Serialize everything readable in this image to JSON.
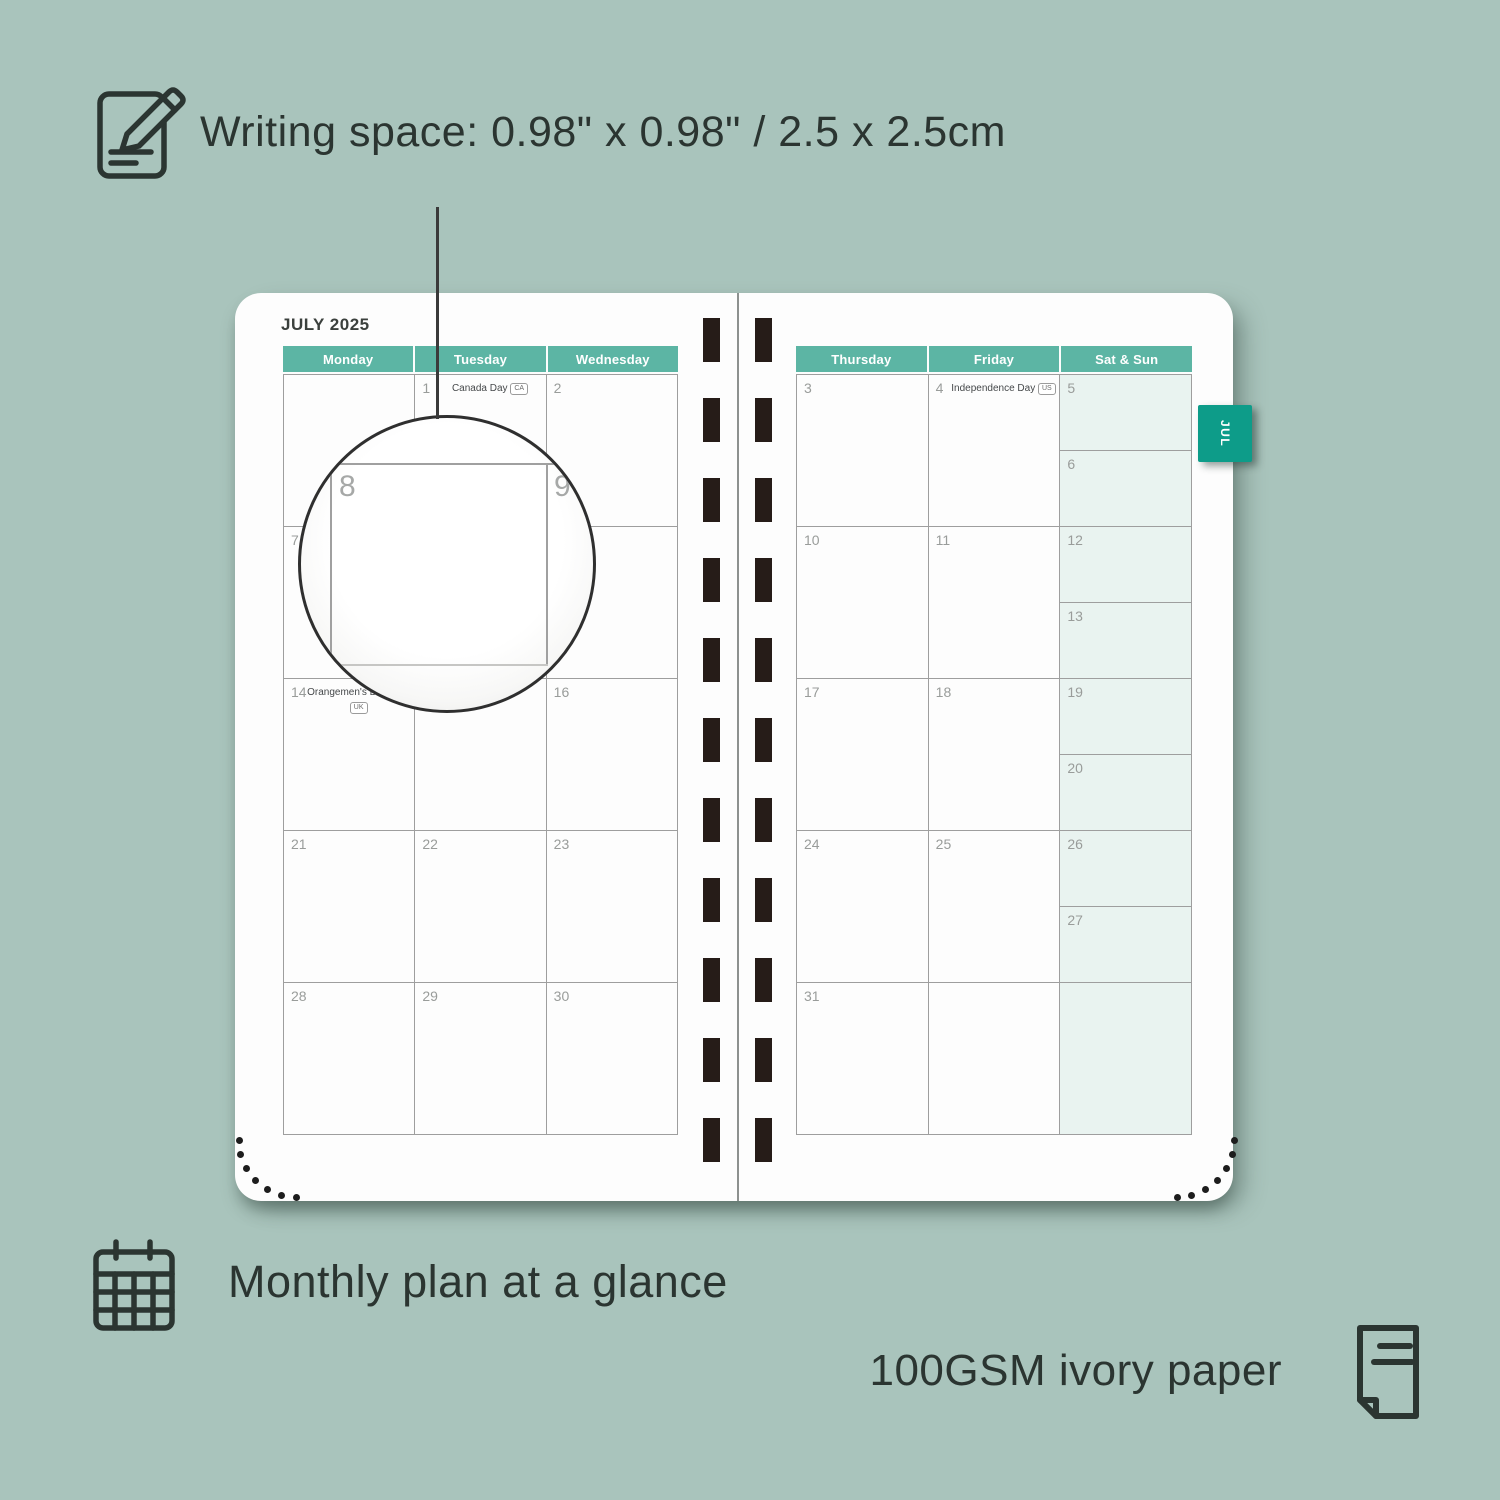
{
  "background_color": "#a9c4bc",
  "captions": {
    "writing_space": "Writing space: 0.98\" x 0.98\" / 2.5 x 2.5cm",
    "monthly_plan": "Monthly plan at a glance",
    "paper": "100GSM ivory paper"
  },
  "icons": [
    "notepad-pencil-icon",
    "calendar-grid-icon",
    "paper-sheet-icon"
  ],
  "planner": {
    "month_title": "JULY 2025",
    "tab_label": "JUL",
    "magnifier": {
      "focus_day": "8",
      "adjacent_day": "9"
    },
    "pages": {
      "left": {
        "headers": [
          "Monday",
          "Tuesday",
          "Wednesday"
        ],
        "rows": [
          [
            {
              "day": ""
            },
            {
              "day": "1",
              "holiday": "Canada Day",
              "badge": "CA"
            },
            {
              "day": "2"
            }
          ],
          [
            {
              "day": "7"
            },
            {
              "day": "8"
            },
            {
              "day": "9"
            }
          ],
          [
            {
              "day": "14",
              "holiday": "Orangemen's Day (n.i.)",
              "badge": "UK"
            },
            {
              "day": "15"
            },
            {
              "day": "16"
            }
          ],
          [
            {
              "day": "21"
            },
            {
              "day": "22"
            },
            {
              "day": "23"
            }
          ],
          [
            {
              "day": "28"
            },
            {
              "day": "29"
            },
            {
              "day": "30"
            }
          ]
        ]
      },
      "right": {
        "headers": [
          "Thursday",
          "Friday",
          "Sat & Sun"
        ],
        "rows": [
          {
            "cells": [
              {
                "day": "3"
              },
              {
                "day": "4",
                "holiday": "Independence Day",
                "badge": "US"
              }
            ],
            "weekend": [
              "5",
              "6"
            ]
          },
          {
            "cells": [
              {
                "day": "10"
              },
              {
                "day": "11"
              }
            ],
            "weekend": [
              "12",
              "13"
            ]
          },
          {
            "cells": [
              {
                "day": "17"
              },
              {
                "day": "18"
              }
            ],
            "weekend": [
              "19",
              "20"
            ]
          },
          {
            "cells": [
              {
                "day": "24"
              },
              {
                "day": "25"
              }
            ],
            "weekend": [
              "26",
              "27"
            ]
          },
          {
            "cells": [
              {
                "day": "31"
              },
              {
                "day": ""
              }
            ],
            "weekend": [
              ""
            ]
          }
        ]
      }
    }
  },
  "colors": {
    "header_teal": "#5cb5a4",
    "tab_teal": "#0d9c89",
    "weekend_bg": "#e9f3f0",
    "caption_text": "#2b3531",
    "spine_black": "#261c18"
  }
}
